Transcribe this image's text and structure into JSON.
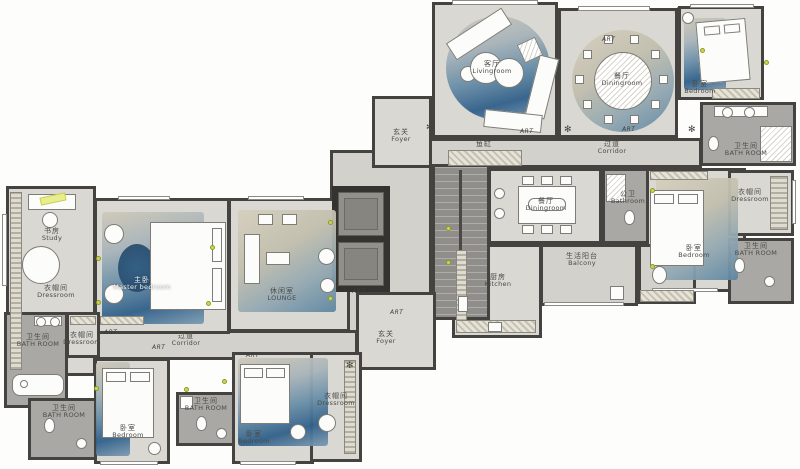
{
  "labels": {
    "art": "ART",
    "fish_tank": "鱼缸"
  },
  "rooms": {
    "livingroom": {
      "zh": "客厅",
      "en": "Livingroom"
    },
    "dining_round": {
      "zh": "餐厅",
      "en": "Diningroom"
    },
    "dining_rect": {
      "zh": "餐厅",
      "en": "Diningroom"
    },
    "bedroom_topright": {
      "zh": "卧室",
      "en": "Bedroom"
    },
    "bedroom_right": {
      "zh": "卧室",
      "en": "Bedroom"
    },
    "bedroom_bottomleft": {
      "zh": "卧室",
      "en": "Bedroom"
    },
    "bedroom_bottommid": {
      "zh": "卧室",
      "en": "Bedroom"
    },
    "master_bedroom": {
      "zh": "主卧",
      "en": "Master bedroom"
    },
    "study": {
      "zh": "书房",
      "en": "Study"
    },
    "lounge": {
      "zh": "休闲室",
      "en": "LOUNGE"
    },
    "kitchen": {
      "zh": "厨房",
      "en": "Kitchen"
    },
    "balcony": {
      "zh": "生活阳台",
      "en": "Balcony"
    },
    "corridor_left": {
      "zh": "过道",
      "en": "Corridor"
    },
    "corridor_right": {
      "zh": "过道",
      "en": "Corridor"
    },
    "foyer_top": {
      "zh": "玄关",
      "en": "Foyer"
    },
    "foyer_bottom": {
      "zh": "玄关",
      "en": "Foyer"
    },
    "bathroom_topright": {
      "zh": "卫生间",
      "en": "BATH ROOM"
    },
    "bathroom_right": {
      "zh": "卫生间",
      "en": "BATH ROOM"
    },
    "bathroom_lefttop": {
      "zh": "卫生间",
      "en": "BATH ROOM"
    },
    "bathroom_leftbottom": {
      "zh": "卫生间",
      "en": "BATH ROOM"
    },
    "bathroom_bottommid": {
      "zh": "卫生间",
      "en": "BATH ROOM"
    },
    "bathroom_public": {
      "zh": "公卫",
      "en": "Bathroom"
    },
    "dressroom_study": {
      "zh": "衣帽间",
      "en": "Dressroom"
    },
    "dressroom_left": {
      "zh": "衣帽间",
      "en": "Dressroom"
    },
    "dressroom_mid": {
      "zh": "衣帽间",
      "en": "Dressroom"
    },
    "dressroom_right": {
      "zh": "衣帽间",
      "en": "Dressroom"
    }
  }
}
